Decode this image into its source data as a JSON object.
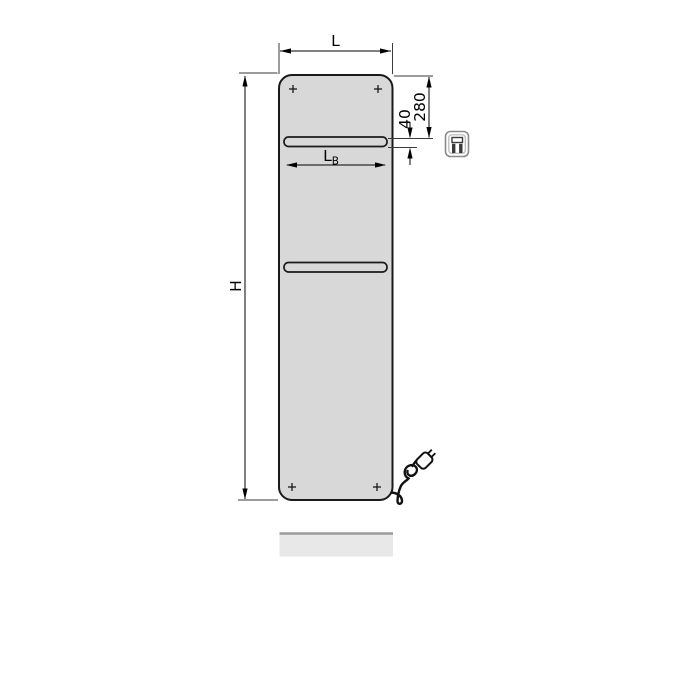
{
  "drawing": {
    "type": "technical-dimension-diagram",
    "subject": "flat-panel-radiator-with-towel-bars-front-view",
    "dimensions": {
      "width_label": "L",
      "height_label": "H",
      "bar_width_label_main": "L",
      "bar_width_label_sub": "B",
      "top_to_bar_value": "280",
      "bar_gap_value": "40"
    },
    "icons": {
      "product_pictogram": "framed-electric-panel-icon",
      "power_plug": "euro-plug-with-coiled-cable",
      "mounting_marks": "plus-cross-screw-points"
    },
    "colors": {
      "background": "#ffffff",
      "panel_fill": "#d8d8d8",
      "panel_stroke": "#1a1a1a",
      "dimension_line": "#000000",
      "extension_line": "#3a3a3a",
      "reflection_fill": "#e8e8e8",
      "reflection_edge": "#9b9b9b",
      "icon_border": "#8a8a8a"
    }
  }
}
